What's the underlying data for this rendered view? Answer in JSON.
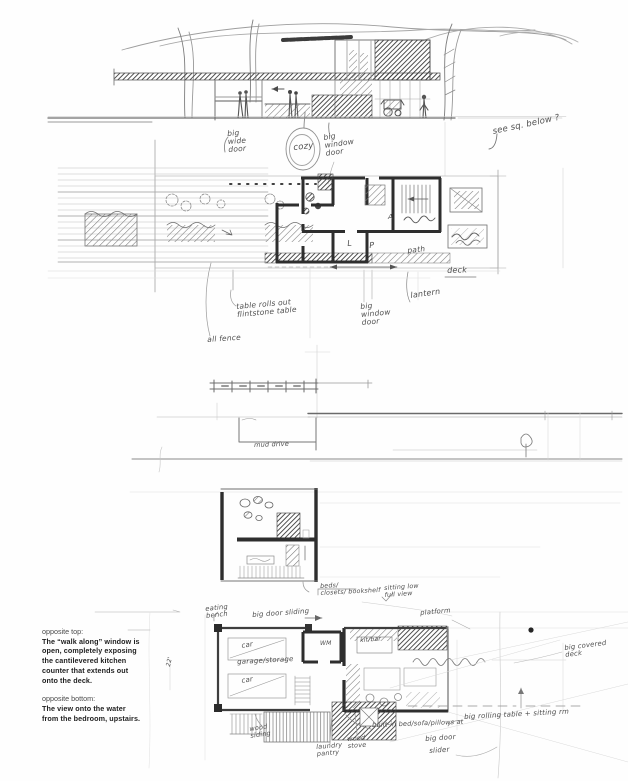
{
  "caption": {
    "top_label": "opposite top:",
    "top_text": "The “walk along” window is open, completely exposing the cantilevered kitchen counter that extends out onto the deck.",
    "bottom_label": "opposite bottom:",
    "bottom_text": "The view onto the water from the bedroom, upstairs."
  },
  "annotations": {
    "big_wide_door": "big\nwide\ndoor",
    "cozy": "cozy",
    "big_window_door_elev": "big\nwindow\ndoor",
    "see_sq_below": "see sq. below ?",
    "room_a": "A",
    "room_l": "L",
    "room_p": "P",
    "path": "path",
    "deck": "deck",
    "table_rolls_out": "table rolls out\nflintstone table",
    "all_fence": "all fence",
    "big_window_door_plan": "big\nwindow\ndoor",
    "lantern": "lantern",
    "mud_drive": "mud drive",
    "beds_closets_bookshelf": "beds/\nclosets/ bookshelf",
    "sitting_low": "sitting low\nfull view",
    "platform": "platform",
    "eating_bench": "eating\nbench",
    "big_door_sliding": "big door sliding",
    "car_1": "car",
    "garage_storage": "garage/storage",
    "car_2": "car",
    "wm": "WM",
    "kit_bar": "kit/bar",
    "dim_22": "22'",
    "big_covered_deck": "big covered\ndeck",
    "built_in": "built-in bed/sofa/pillows at",
    "big_rolling_table": "big rolling table + sitting rm",
    "big_door": "big door",
    "slider": "slider",
    "wood_siding": "wood\nsiding",
    "laundry_pantry": "laundry\npantry",
    "wood_stove": "wood\nstove"
  },
  "colors": {
    "paper": "#fefefe",
    "pencil_light": "#aaaaaa",
    "pencil": "#7d7d7d",
    "pencil_dark": "#3d3d3d",
    "caption_text": "#1f1f1f"
  }
}
